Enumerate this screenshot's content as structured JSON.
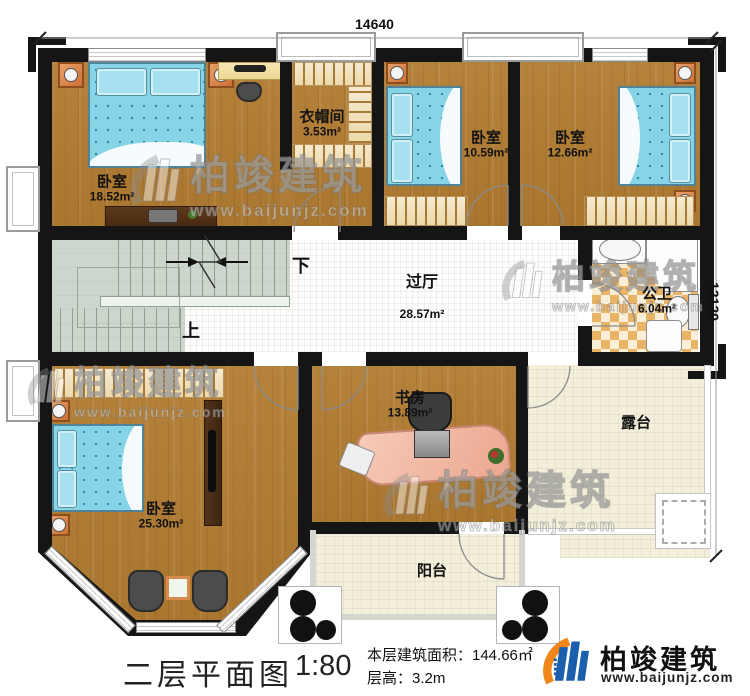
{
  "dimensions": {
    "top": "14640",
    "right": "12120"
  },
  "rooms": {
    "bedroom_tl": {
      "name": "卧室",
      "area": "18.52m²"
    },
    "cloakroom": {
      "name": "衣帽间",
      "area": "3.53m²"
    },
    "bedroom_tm": {
      "name": "卧室",
      "area": "10.59m²"
    },
    "bedroom_tr": {
      "name": "卧室",
      "area": "12.66m²"
    },
    "hall": {
      "name": "过厅",
      "area": "28.57m²"
    },
    "bathroom": {
      "name": "公卫",
      "area": "6.04m²"
    },
    "bedroom_bl": {
      "name": "卧室",
      "area": "25.30m²"
    },
    "study": {
      "name": "书房",
      "area": "13.89m²"
    },
    "terrace": {
      "name": "露台"
    },
    "balcony": {
      "name": "阳台"
    }
  },
  "stairs": {
    "down": "下",
    "up": "上"
  },
  "title_block": {
    "title": "二层平面图",
    "scale": "1:80",
    "area_line": "本层建筑面积：144.66㎡",
    "height_line": "层高：3.2m"
  },
  "logo": {
    "name": "柏竣建筑",
    "url": "www.baijunjz.com"
  },
  "watermark": {
    "name": "柏竣建筑",
    "url": "www.baijunjz.com"
  },
  "colors": {
    "wall": "#151515",
    "wood": "#ad7a33",
    "bed": "#87d4e6",
    "bath_tile": "#e9b466",
    "hall_tile": "#fdfdfb",
    "stair": "#cdd6cc",
    "terrace": "#f3efda",
    "logo_blue": "#1a5fae",
    "logo_orange": "#f08519"
  }
}
